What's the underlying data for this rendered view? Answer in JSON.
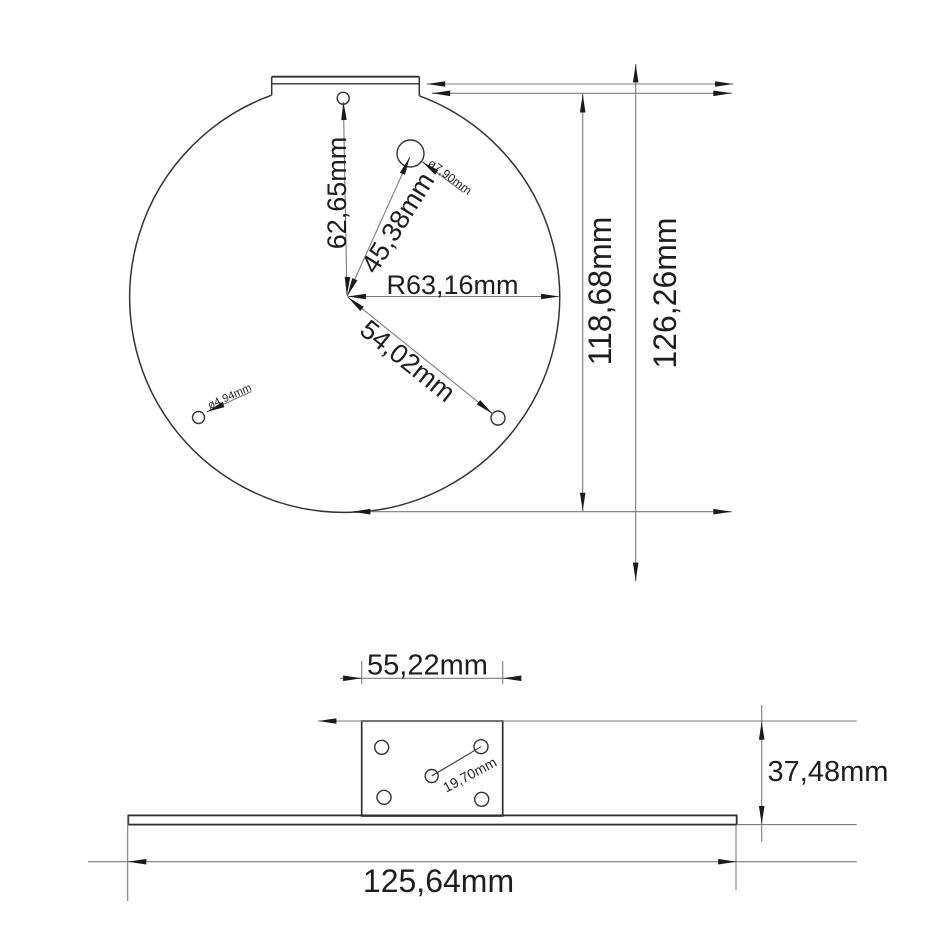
{
  "drawing": {
    "title": "mounting-plate-dimension-drawing",
    "colors": {
      "background": "#ffffff",
      "geometry": "#333335",
      "dimension_lines": "#7b7b7d",
      "arrows": "#1a1a1a",
      "text": "#1e1e1e"
    },
    "top_view": {
      "dims": {
        "center_to_top_hole": "62,65mm",
        "center_to_large_hole": "45,38mm",
        "radius": "R63,16mm",
        "center_to_lower_hole": "54,02mm",
        "large_hole_dia": "ø7,90mm",
        "small_hole_dia": "ø4,94mm",
        "inner_height": "118,68mm",
        "overall_height": "126,26mm"
      }
    },
    "side_view": {
      "dims": {
        "tab_width": "55,22mm",
        "hole_spacing": "19,70mm",
        "bracket_height": "37,48mm",
        "base_width": "125,64mm"
      }
    }
  }
}
